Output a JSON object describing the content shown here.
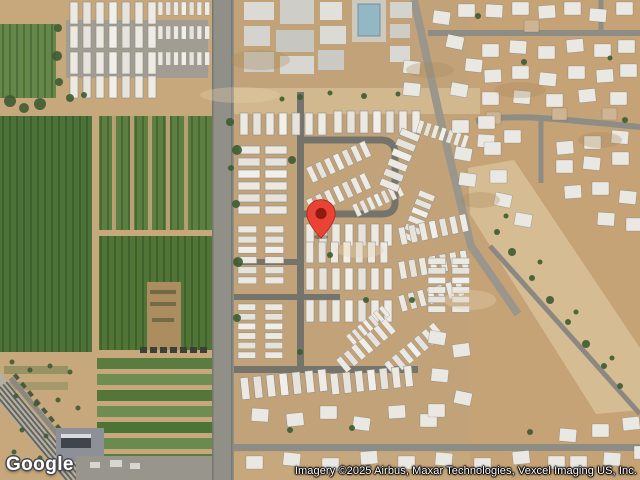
{
  "map": {
    "imagery_type": "satellite",
    "marker": {
      "x_px": 321,
      "y_px": 239,
      "pin_color": "#EA4335",
      "pin_border_color": "#A52714",
      "dot_color": "#8E1B0D"
    }
  },
  "branding": {
    "logo_text": "Google"
  },
  "attribution": {
    "text": "Imagery ©2025 Airbus, Maxar Technologies, Vexcel Imaging US, Inc."
  }
}
